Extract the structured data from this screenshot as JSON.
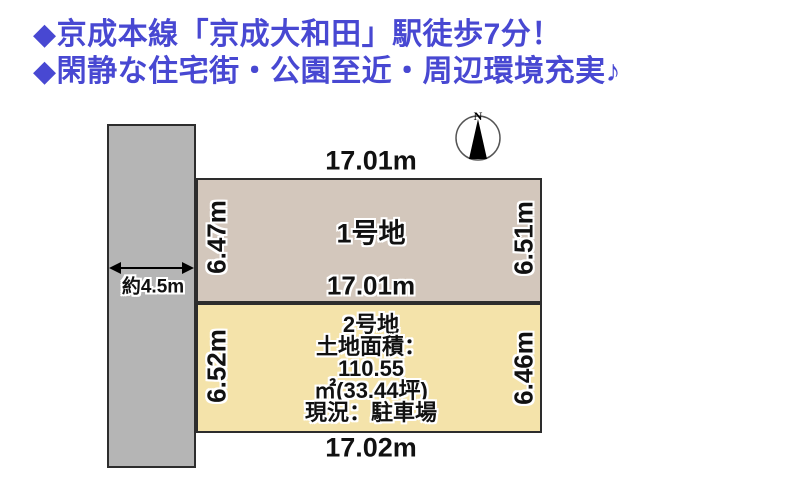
{
  "header": {
    "line1": "◆京成本線「京成大和田」駅徒歩7分！",
    "line2": "◆閑静な住宅街・公園至近・周辺環境充実♪",
    "text_color": "#4848d2"
  },
  "compass": {
    "north_label": "N"
  },
  "road": {
    "width_label": "約4.5m",
    "fill_color": "#b5b5b5"
  },
  "plot1": {
    "name": "1号地",
    "top_dim": "17.01m",
    "bottom_dim": "17.01m",
    "left_dim": "6.47m",
    "right_dim": "6.51m",
    "fill_color": "#d3c7bc"
  },
  "plot2": {
    "name": "2号地",
    "left_dim": "6.52m",
    "right_dim": "6.46m",
    "bottom_dim": "17.02m",
    "fill_color": "#f4e3aa",
    "detail_lines": [
      "土地面積：",
      "110.55",
      "㎡(33.44坪)",
      "現況：駐車場"
    ]
  }
}
